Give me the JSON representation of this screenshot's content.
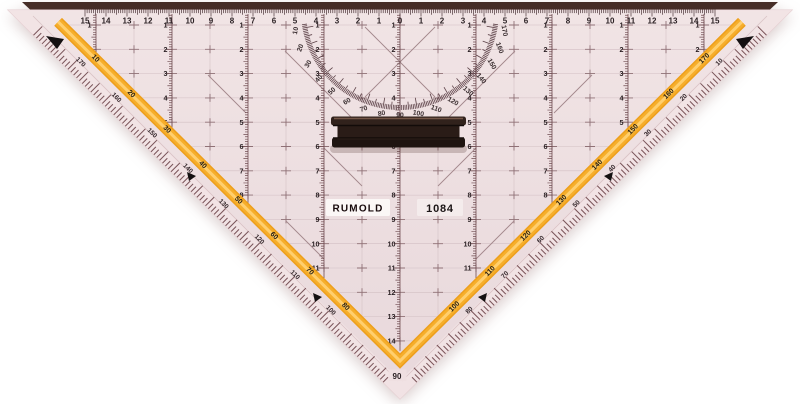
{
  "product": {
    "brand": "RUMOLD",
    "model": "1084",
    "apex_label": "90"
  },
  "top_ruler": {
    "labels": [
      "15",
      "14",
      "13",
      "12",
      "11",
      "10",
      "9",
      "8",
      "7",
      "6",
      "5",
      "4",
      "3",
      "2",
      "1",
      "0",
      "1",
      "2",
      "3",
      "4",
      "5",
      "6",
      "7",
      "8",
      "9",
      "10",
      "11",
      "12",
      "13",
      "14",
      "15"
    ]
  },
  "protractor": {
    "labels": [
      "10",
      "20",
      "30",
      "40",
      "50",
      "60",
      "70",
      "80",
      "90",
      "100",
      "110",
      "120",
      "130",
      "140",
      "150",
      "160",
      "170"
    ]
  },
  "edges": {
    "left": {
      "stripe_labels": [
        "10",
        "20",
        "30",
        "40",
        "50",
        "60",
        "70",
        "80"
      ],
      "bevel_labels": [
        "170",
        "160",
        "150",
        "140",
        "130",
        "120",
        "110",
        "100"
      ]
    },
    "right": {
      "stripe_labels": [
        "170",
        "160",
        "150",
        "140",
        "130",
        "120",
        "110",
        "100"
      ],
      "bevel_labels": [
        "10",
        "20",
        "30",
        "40",
        "50",
        "60",
        "70",
        "80"
      ]
    }
  },
  "vertical_scales": [
    {
      "labels": [
        "1",
        "2"
      ]
    },
    {
      "labels": [
        "1",
        "2",
        "3",
        "4",
        "5"
      ]
    },
    {
      "labels": [
        "1",
        "2",
        "3",
        "4",
        "5",
        "6",
        "7",
        "8"
      ]
    },
    {
      "labels": [
        "1",
        "2",
        "3",
        "4",
        "5",
        "6",
        "7",
        "8",
        "9",
        "10",
        "11"
      ]
    },
    {
      "labels": [
        "1",
        "2",
        "3",
        "4",
        "5",
        "6",
        "7",
        "8",
        "9",
        "10",
        "11",
        "12",
        "13",
        "14"
      ]
    },
    {
      "labels": [
        "1",
        "2",
        "3",
        "4",
        "5",
        "6",
        "7",
        "8",
        "9",
        "10",
        "11"
      ]
    },
    {
      "labels": [
        "1",
        "2",
        "3",
        "4",
        "5",
        "6",
        "7",
        "8"
      ]
    },
    {
      "labels": [
        "1",
        "2",
        "3",
        "4",
        "5"
      ]
    },
    {
      "labels": [
        "1",
        "2"
      ]
    }
  ],
  "colors": {
    "body_top": "#F1E4E5",
    "body_bottom": "#E8D8DB",
    "bevel": "#F2E4E5",
    "outline": "#E4CDD0",
    "grid_faint": "#D2BFC3",
    "grid_cross": "#8F7176",
    "diag": "#A3878C",
    "scale_ink": "#2B2124",
    "protractor_ink": "#3A2E30",
    "tick_maroon": "#6F4B50",
    "edge_tick": "#7A555A",
    "stripe_edge": "#ED9F1C",
    "stripe_mid": "#F6AE2B",
    "stripe_highlight": "#FFCF6E",
    "top_strip": "#462D27",
    "handle_dark": "#251913",
    "label_bg": "#FBF7F6",
    "arrow_black": "#141011"
  }
}
